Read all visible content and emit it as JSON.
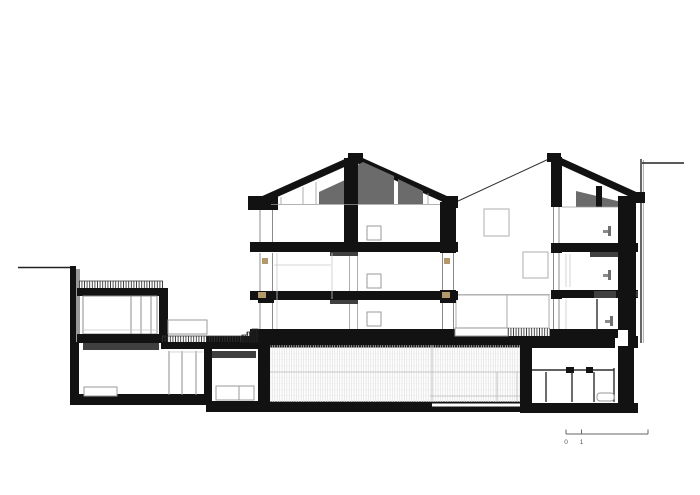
{
  "page": {
    "background": "#ffffff"
  },
  "colors": {
    "ink_black": "#121212",
    "roof_gray": "#6b6b6b",
    "dark_gray": "#404040",
    "timber_tan": "#b3986c",
    "shadow_gray": "#9a9a9a",
    "frame_gray": "#8c8c8c",
    "hatch_dark": "#2a2a2a",
    "hatch_light": "#d9d9d9"
  },
  "symbols": {
    "fixture": "plumbing-fixture-side-profile",
    "bathtub": "bathtub-outline",
    "green_roof_hatch": "vertical-tick-hatch",
    "ramp_hatch": "dense-tick-hatch",
    "pool_hatch": "fine-line-hatch"
  },
  "scale_bar": {
    "labels": [
      "0",
      "1",
      "5"
    ]
  }
}
